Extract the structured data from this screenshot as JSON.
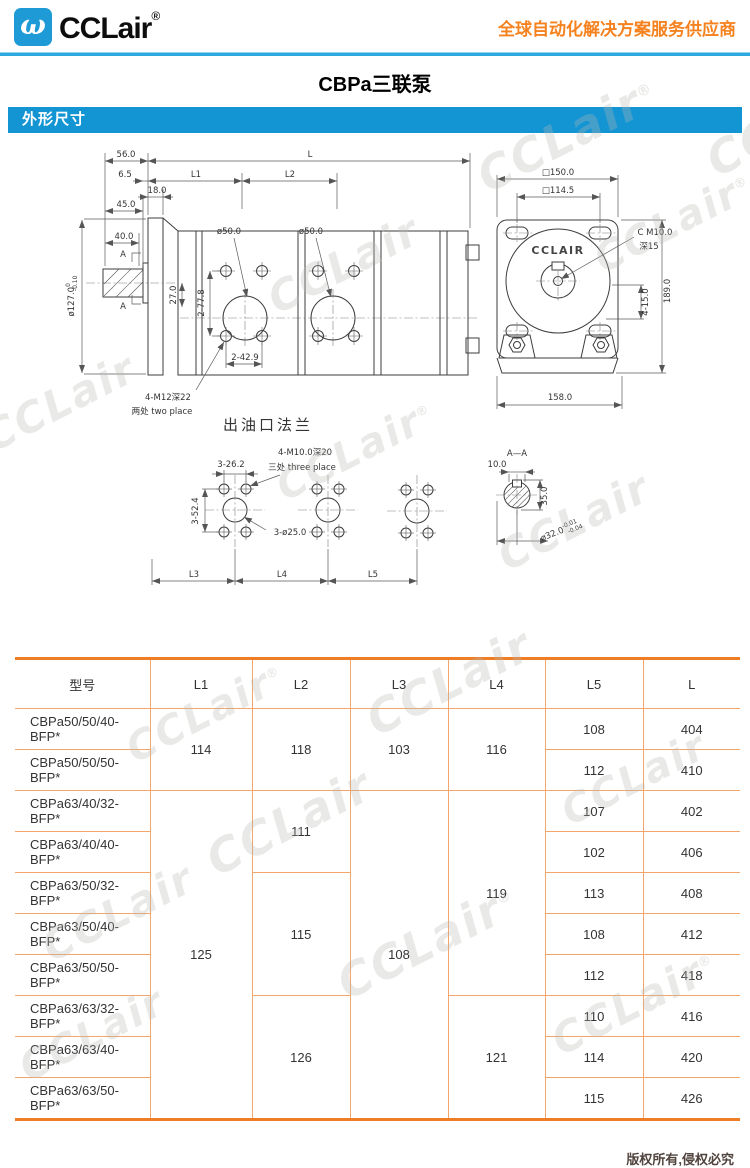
{
  "header": {
    "brand": "CCLair",
    "reg": "®",
    "logo_glyph": "ω",
    "slogan": "全球自动化解决方案服务供应商"
  },
  "title": "CBPa三联泵",
  "section_banner": "外形尺寸",
  "watermark": {
    "text": "CCLair",
    "reg": "®"
  },
  "drawing": {
    "side": {
      "d56": "56.0",
      "d65": "6.5",
      "d18": "18.0",
      "d45": "45.0",
      "d40": "40.0",
      "dL": "L",
      "dL1": "L1",
      "dL2": "L2",
      "d127": "ø127.0",
      "d127_tol_hi": "0",
      "d127_tol_lo": "-0.10",
      "d27": "27.0",
      "d778": "2-77.8",
      "d50a": "ø50.0",
      "d50b": "ø50.0",
      "d429": "2-42.9",
      "m12": "4-M12深22",
      "m12_note": "两处 two place",
      "a_mark": "A"
    },
    "end": {
      "sq150": "□150.0",
      "sq1145": "□114.5",
      "brand": "CCLAIR",
      "cm10": "C M10.0",
      "cm10_depth": "深15",
      "d415": "4-15.0",
      "d189": "189.0",
      "d158": "158.0"
    },
    "outlet": {
      "title": "出油口法兰",
      "m10": "4-M10.0深20",
      "m10_note": "三处 three place",
      "d262": "3-26.2",
      "d524": "3-52.4",
      "d25": "3-ø25.0",
      "dL3": "L3",
      "dL4": "L4",
      "dL5": "L5"
    },
    "section": {
      "title": "A—A",
      "d10": "10.0",
      "d35": "35.0",
      "d32": "ø32.0",
      "d32_tol_hi": "-0.01",
      "d32_tol_lo": "-0.04"
    }
  },
  "table": {
    "headers": {
      "model": "型号",
      "l1": "L1",
      "l2": "L2",
      "l3": "L3",
      "l4": "L4",
      "l5": "L5",
      "l": "L"
    },
    "spans": {
      "l1_12": "114",
      "l1_310": "125",
      "l2_12": "118",
      "l2_34": "111",
      "l2_57": "115",
      "l2_810": "126",
      "l3_12": "103",
      "l3_310": "108",
      "l4_12": "116",
      "l4_37": "119",
      "l4_810": "121"
    },
    "rows": [
      {
        "model": "CBPa50/50/40-BFP*",
        "l5": "108",
        "l": "404"
      },
      {
        "model": "CBPa50/50/50-BFP*",
        "l5": "112",
        "l": "410"
      },
      {
        "model": "CBPa63/40/32-BFP*",
        "l5": "107",
        "l": "402"
      },
      {
        "model": "CBPa63/40/40-BFP*",
        "l5": "102",
        "l": "406"
      },
      {
        "model": "CBPa63/50/32-BFP*",
        "l5": "113",
        "l": "408"
      },
      {
        "model": "CBPa63/50/40-BFP*",
        "l5": "108",
        "l": "412"
      },
      {
        "model": "CBPa63/50/50-BFP*",
        "l5": "112",
        "l": "418"
      },
      {
        "model": "CBPa63/63/32-BFP*",
        "l5": "110",
        "l": "416"
      },
      {
        "model": "CBPa63/63/40-BFP*",
        "l5": "114",
        "l": "420"
      },
      {
        "model": "CBPa63/63/50-BFP*",
        "l5": "115",
        "l": "426"
      }
    ]
  },
  "footer": {
    "copyright": "版权所有,侵权必究"
  }
}
